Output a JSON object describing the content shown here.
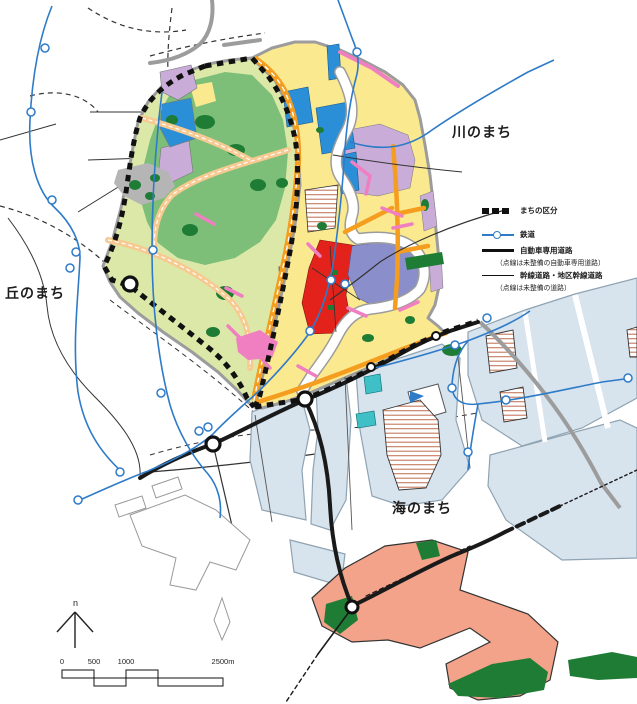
{
  "districts": {
    "river": {
      "label": "川のまち"
    },
    "hill": {
      "label": "丘のまち"
    },
    "sea": {
      "label": "海のまち"
    }
  },
  "legend": {
    "items": [
      {
        "id": "district-boundary",
        "label": "まちの区分"
      },
      {
        "id": "railway",
        "label": "鉄道"
      },
      {
        "id": "motorway",
        "label": "自動車専用道路",
        "note": "（点線は未整備の自動車専用道路）"
      },
      {
        "id": "arterial",
        "label": "幹線道路・地区幹線道路",
        "note": "（点線は未整備の道路）"
      }
    ]
  },
  "north_arrow": {
    "label": "n"
  },
  "scale_bar": {
    "tick_labels": [
      "0",
      "500",
      "1000",
      "2500m"
    ]
  },
  "palette": {
    "pale_green": "#DCE8A8",
    "forest_green": "#7DBE78",
    "dark_green": "#1E7C35",
    "residential_yellow": "#FBE98F",
    "lavender": "#C9ADD8",
    "facility_blue": "#2B8FD8",
    "center_periwinkle": "#8A8FCC",
    "center_red": "#E3231B",
    "road_orange": "#F49D1F",
    "road_tan": "#F7CA92",
    "road_pink": "#EF7FC1",
    "new_town_salmon": "#F2A389",
    "port_blue": "#D7E3ED",
    "teal": "#3FBFC6",
    "rail_blue": "#2E7BC8",
    "hatch_brown": "#C4795B",
    "road_gray": "#9C9C9C"
  }
}
